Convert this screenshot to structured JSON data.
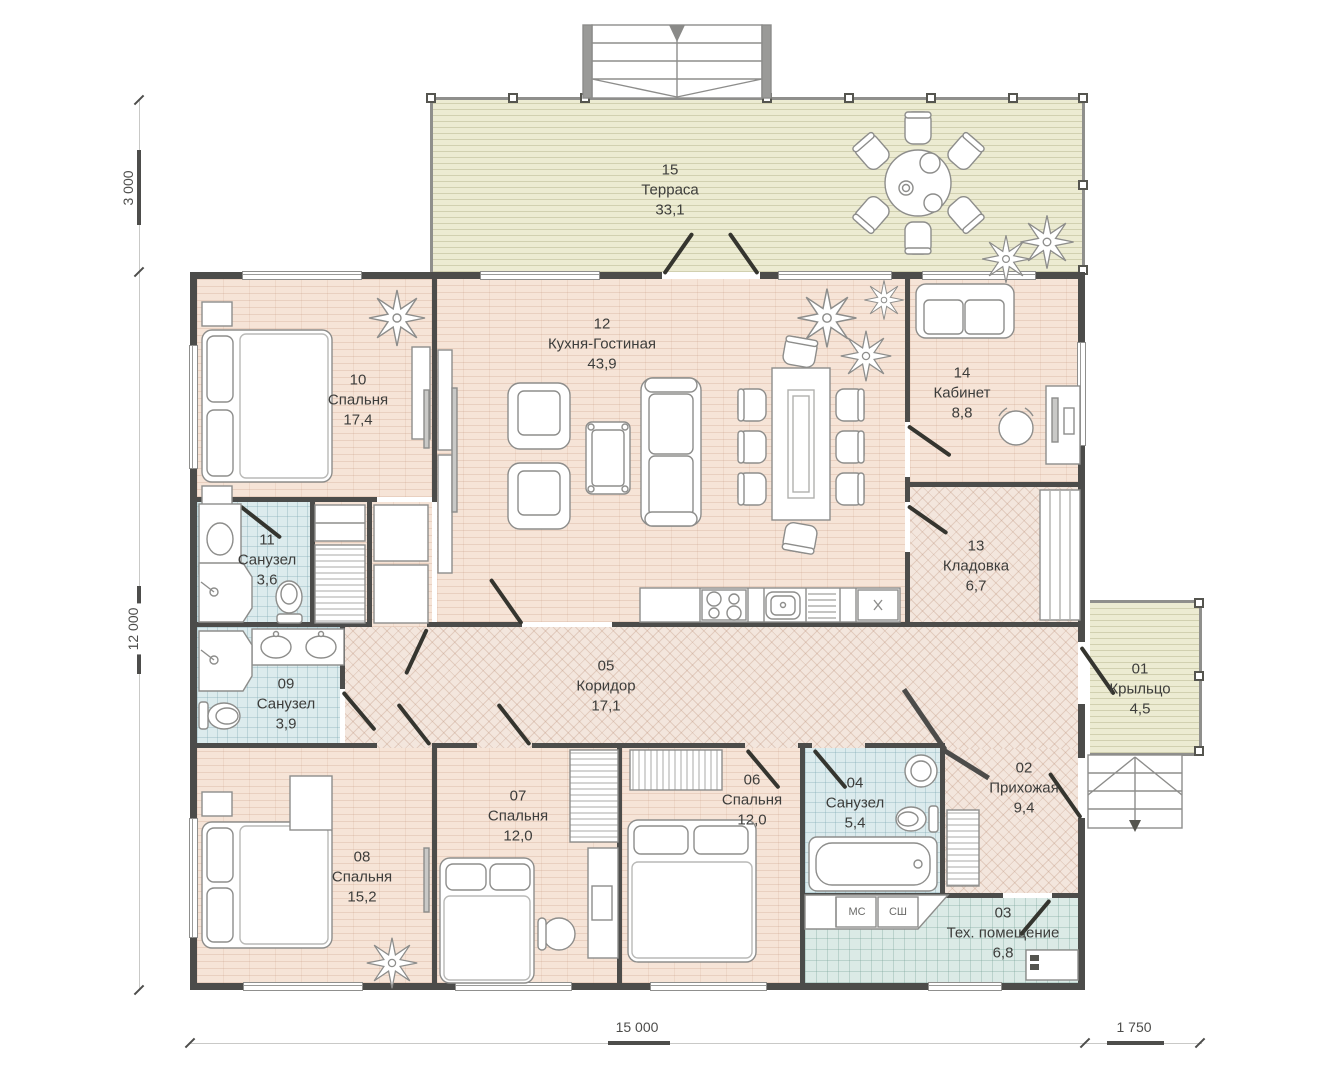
{
  "plan": {
    "rooms": [
      {
        "num": "01",
        "name": "Крыльцо",
        "area": "4,5"
      },
      {
        "num": "02",
        "name": "Прихожая",
        "area": "9,4"
      },
      {
        "num": "03",
        "name": "Тех. помещение",
        "area": "6,8"
      },
      {
        "num": "04",
        "name": "Санузел",
        "area": "5,4"
      },
      {
        "num": "05",
        "name": "Коридор",
        "area": "17,1"
      },
      {
        "num": "06",
        "name": "Спальня",
        "area": "12,0"
      },
      {
        "num": "07",
        "name": "Спальня",
        "area": "12,0"
      },
      {
        "num": "08",
        "name": "Спальня",
        "area": "15,2"
      },
      {
        "num": "09",
        "name": "Санузел",
        "area": "3,9"
      },
      {
        "num": "10",
        "name": "Спальня",
        "area": "17,4"
      },
      {
        "num": "11",
        "name": "Санузел",
        "area": "3,6"
      },
      {
        "num": "12",
        "name": "Кухня-Гостиная",
        "area": "43,9"
      },
      {
        "num": "13",
        "name": "Кладовка",
        "area": "6,7"
      },
      {
        "num": "14",
        "name": "Кабинет",
        "area": "8,8"
      },
      {
        "num": "15",
        "name": "Терраса",
        "area": "33,1"
      }
    ],
    "appliance_labels": {
      "washer": "МС",
      "dryer": "СШ"
    },
    "dimensions": {
      "terrace_depth": "3 000",
      "house_depth": "12 000",
      "house_width": "15 000",
      "porch_width": "1 750"
    },
    "colors": {
      "wall": "#4c4c4a",
      "floor_wood": "#f6e4d7",
      "floor_tile": "#dcebed",
      "floor_tech": "#dbeae6",
      "deck": "#ecebd2",
      "corridor": "#f3e6dd"
    }
  }
}
